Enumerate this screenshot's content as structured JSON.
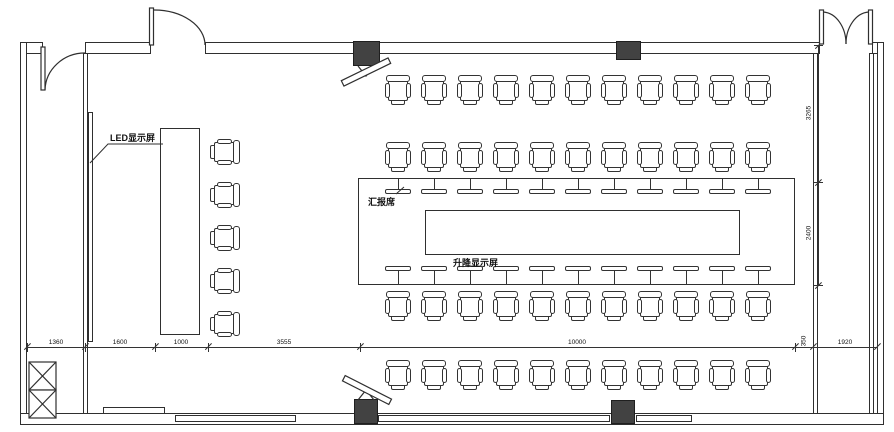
{
  "drawing": {
    "type": "conference-room-floor-plan",
    "labels": {
      "led_screen": "LED显示屏",
      "reporter_seat": "汇报席",
      "lift_display": "升降显示屏"
    },
    "dimensions": {
      "bottom": [
        "1360",
        "1600",
        "1000",
        "3555",
        "10000",
        "350",
        "1920"
      ],
      "right": [
        "3265",
        "2400"
      ]
    },
    "furniture": {
      "chair_rows": [
        {
          "name": "top-row-outer",
          "count": 11
        },
        {
          "name": "top-row-inner",
          "count": 11
        },
        {
          "name": "bottom-row-inner",
          "count": 11
        },
        {
          "name": "bottom-row-outer",
          "count": 11
        },
        {
          "name": "left-column",
          "count": 5
        }
      ],
      "table_seats_top": 11,
      "table_seats_bottom": 11,
      "doors": [
        "single-door-top-left-corridor",
        "single-door-top-left",
        "double-door-top-right"
      ],
      "shaft_cells": 2
    },
    "colors": {
      "line": "#2f2f2f",
      "column_fill": "#424242",
      "background": "#ffffff"
    }
  }
}
